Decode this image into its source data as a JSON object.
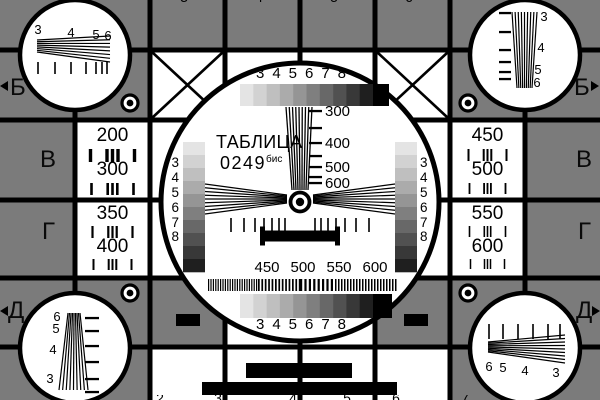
{
  "colors": {
    "background": "#7b7b7b",
    "ink": "#000000",
    "cell": "#ffffff"
  },
  "title": {
    "name": "ТАБЛИЦА",
    "number": "0249",
    "suffix": "бис"
  },
  "edge_letters": {
    "left": [
      "Б",
      "В",
      "Г",
      "Д"
    ],
    "right": [
      "Б",
      "В",
      "Г",
      "Д"
    ]
  },
  "grayscale_labels": {
    "top": [
      "3",
      "4",
      "5",
      "6",
      "7",
      "8"
    ],
    "bottom": [
      "3",
      "4",
      "5",
      "6",
      "7",
      "8"
    ],
    "left": [
      "3",
      "4",
      "5",
      "6",
      "7",
      "8"
    ],
    "right": [
      "3",
      "4",
      "5",
      "6",
      "7",
      "8"
    ]
  },
  "frequency_scale": [
    "300",
    "400",
    "500",
    "600"
  ],
  "burst_labels": [
    "450",
    "500",
    "550",
    "600"
  ],
  "resolution_cells": {
    "left_top": [
      "200",
      "300"
    ],
    "left_bottom": [
      "350",
      "400"
    ],
    "right_top": [
      "450",
      "500"
    ],
    "right_bottom": [
      "550",
      "600"
    ]
  },
  "corner_wedge_labels": {
    "top_left": [
      "3",
      "4",
      "5",
      "6"
    ],
    "top_right": [
      "3",
      "4",
      "5",
      "6"
    ],
    "bottom_left": [
      "6",
      "5",
      "4",
      "3"
    ],
    "bottom_right": [
      "6",
      "5",
      "4",
      "3"
    ]
  },
  "edge_digit_fragments": {
    "top": [
      "3",
      "4",
      "5",
      "6"
    ],
    "bottom": [
      "2",
      "3",
      "4",
      "5",
      "6",
      "7"
    ]
  },
  "grayscale_steps": [
    "#e4e4e4",
    "#d2d2d2",
    "#bfbfbf",
    "#ababab",
    "#959595",
    "#7f7f7f",
    "#686868",
    "#515151",
    "#383838",
    "#1f1f1f"
  ],
  "grayscale_tail": "#000000"
}
